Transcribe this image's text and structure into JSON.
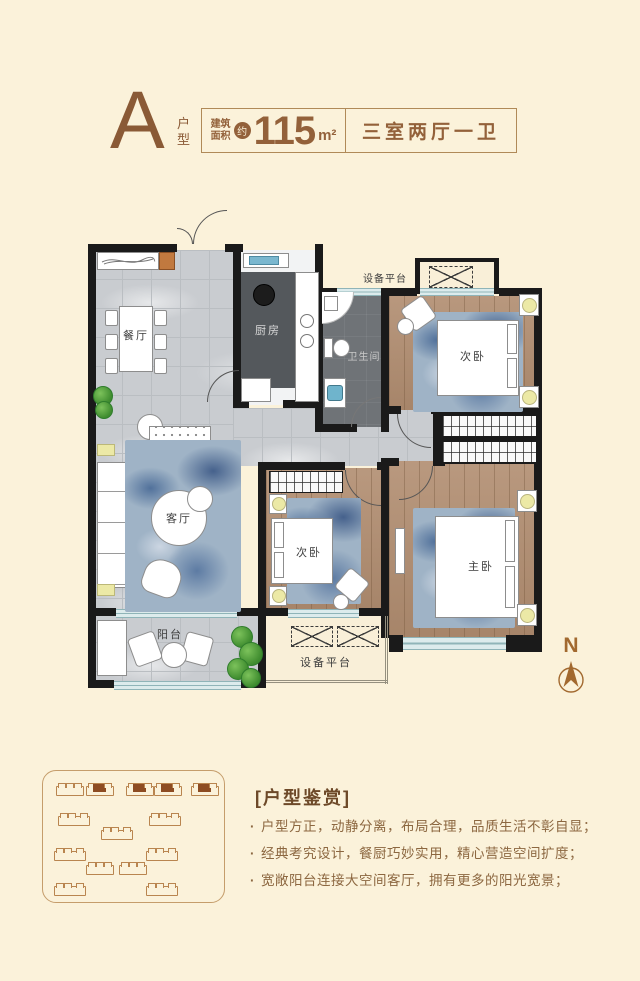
{
  "header": {
    "unit_letter": "A",
    "unit_type": "户型",
    "area_label_line1": "建筑",
    "area_label_line2": "面积",
    "area_approx": "约",
    "area_value": "115",
    "area_unit": "m²",
    "layout_summary": "三室两厅一卫"
  },
  "floorplan": {
    "rooms": {
      "dining": "餐厅",
      "kitchen": "厨房",
      "bathroom": "卫生间",
      "bedroom_top": "次卧",
      "living": "客厅",
      "bedroom_mid": "次卧",
      "master_bedroom": "主卧",
      "balcony": "阳台",
      "equipment_top": "设备平台",
      "equipment_bottom": "设备平台"
    },
    "compass": {
      "north_label": "N"
    }
  },
  "appreciation": {
    "bracket_open": "[",
    "title": "户型鉴赏",
    "bracket_close": "]",
    "bullet_glyph": "·",
    "bullets": [
      "户型方正，动静分离，布局合理，品质生活不彰自显；",
      "经典考究设计，餐厨巧妙实用，精心营造空间扩度；",
      "宽敞阳台连接大空间客厅，拥有更多的阳光宽景；"
    ]
  },
  "colors": {
    "background": "#fbf2da",
    "accent_brown": "#93613a",
    "wall_black": "#1a1a1a",
    "window_blue": "#8fb4b8",
    "wood_floor": "#b18d70",
    "tile_gray": "#c9ccd0",
    "rug_blue": "#9fb3c6",
    "plant_green": "#4d9a3c",
    "lamp_yellow": "#ece9a6",
    "highlight_building": "#8d4c22"
  }
}
